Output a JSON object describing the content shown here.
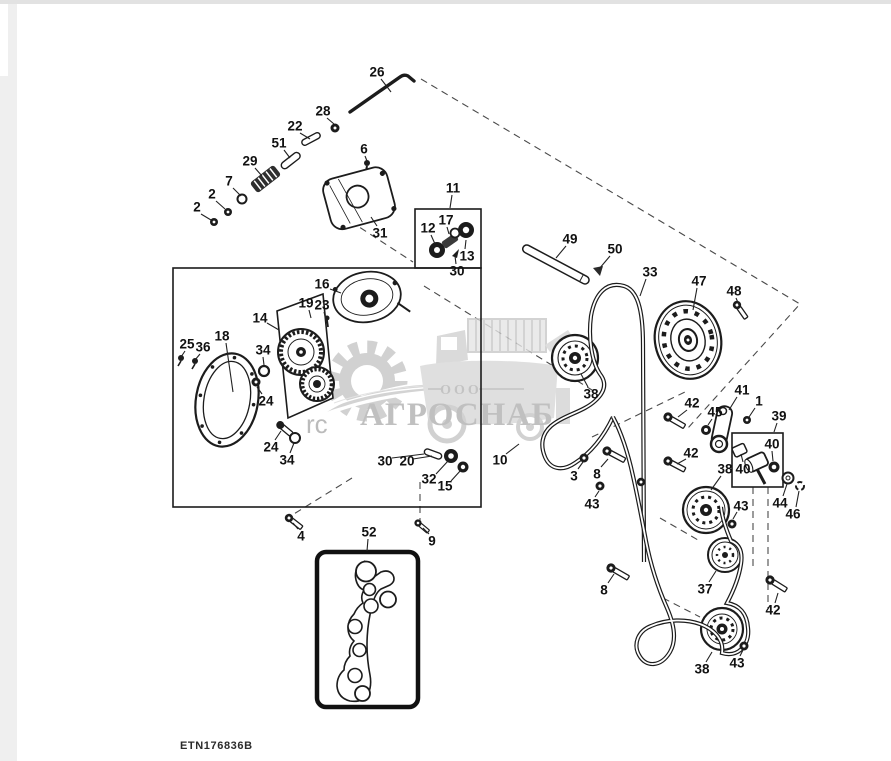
{
  "diagram": {
    "figure_code": "ETN176836B",
    "watermark": {
      "company_type": "ООО",
      "company_name": "АГРОСНАБ",
      "fragment": "rc"
    },
    "callouts": [
      {
        "n": "26",
        "x": 377,
        "y": 72,
        "l": [
          381,
          79,
          391,
          92
        ]
      },
      {
        "n": "28",
        "x": 323,
        "y": 111,
        "l": [
          327,
          118,
          334,
          124
        ]
      },
      {
        "n": "22",
        "x": 295,
        "y": 126,
        "l": [
          300,
          133,
          310,
          139
        ]
      },
      {
        "n": "51",
        "x": 279,
        "y": 143,
        "l": [
          284,
          150,
          290,
          158
        ]
      },
      {
        "n": "29",
        "x": 250,
        "y": 161,
        "l": [
          255,
          168,
          262,
          176
        ]
      },
      {
        "n": "7",
        "x": 229,
        "y": 181,
        "l": [
          233,
          188,
          241,
          196
        ]
      },
      {
        "n": "2",
        "x": 212,
        "y": 194,
        "l": [
          216,
          201,
          225,
          209
        ]
      },
      {
        "n": "2",
        "x": 197,
        "y": 207,
        "l": [
          201,
          214,
          211,
          220
        ]
      },
      {
        "n": "6",
        "x": 364,
        "y": 149,
        "l": [
          365,
          156,
          367,
          161
        ]
      },
      {
        "n": "31",
        "x": 380,
        "y": 233,
        "l": [
          377,
          226,
          371,
          217
        ]
      },
      {
        "n": "11",
        "x": 453,
        "y": 188,
        "l": [
          452,
          195,
          450,
          208
        ]
      },
      {
        "n": "12",
        "x": 428,
        "y": 228,
        "l": [
          431,
          235,
          435,
          244
        ]
      },
      {
        "n": "17",
        "x": 446,
        "y": 220,
        "l": [
          447,
          227,
          449,
          234
        ]
      },
      {
        "n": "13",
        "x": 467,
        "y": 256,
        "l": [
          465,
          249,
          466,
          240
        ]
      },
      {
        "n": "30",
        "x": 457,
        "y": 271,
        "l": [
          456,
          264,
          455,
          256
        ]
      },
      {
        "n": "16",
        "x": 322,
        "y": 284,
        "l": [
          330,
          289,
          341,
          293
        ]
      },
      {
        "n": "19",
        "x": 306,
        "y": 303,
        "l": [
          309,
          310,
          311,
          318
        ]
      },
      {
        "n": "23",
        "x": 322,
        "y": 305,
        "l": [
          324,
          312,
          326,
          320
        ]
      },
      {
        "n": "14",
        "x": 260,
        "y": 318,
        "l": [
          267,
          323,
          279,
          330
        ]
      },
      {
        "n": "18",
        "x": 222,
        "y": 336,
        "l": [
          226,
          343,
          233,
          392
        ]
      },
      {
        "n": "25",
        "x": 187,
        "y": 344,
        "l": [
          185,
          351,
          181,
          357
        ]
      },
      {
        "n": "36",
        "x": 203,
        "y": 347,
        "l": [
          200,
          354,
          195,
          360
        ]
      },
      {
        "n": "34",
        "x": 263,
        "y": 350,
        "l": [
          263,
          357,
          264,
          365
        ]
      },
      {
        "n": "24",
        "x": 266,
        "y": 401,
        "l": [
          262,
          394,
          257,
          387
        ]
      },
      {
        "n": "24",
        "x": 271,
        "y": 447,
        "l": [
          275,
          440,
          281,
          431
        ]
      },
      {
        "n": "34",
        "x": 287,
        "y": 460,
        "l": [
          290,
          453,
          294,
          443
        ]
      },
      {
        "n": "30",
        "x": 385,
        "y": 461,
        "l": [
          392,
          458,
          424,
          454
        ]
      },
      {
        "n": "20",
        "x": 407,
        "y": 461,
        "l": [
          413,
          459,
          432,
          456
        ]
      },
      {
        "n": "32",
        "x": 429,
        "y": 479,
        "l": [
          436,
          474,
          448,
          461
        ]
      },
      {
        "n": "15",
        "x": 445,
        "y": 486,
        "l": [
          451,
          481,
          461,
          470
        ]
      },
      {
        "n": "4",
        "x": 301,
        "y": 536,
        "l": [
          298,
          529,
          293,
          523
        ]
      },
      {
        "n": "52",
        "x": 369,
        "y": 532,
        "l": [
          368,
          539,
          367,
          551
        ]
      },
      {
        "n": "9",
        "x": 432,
        "y": 541,
        "l": [
          429,
          534,
          423,
          528
        ]
      },
      {
        "n": "49",
        "x": 570,
        "y": 239,
        "l": [
          566,
          246,
          556,
          258
        ]
      },
      {
        "n": "50",
        "x": 615,
        "y": 249,
        "l": [
          610,
          256,
          599,
          269
        ]
      },
      {
        "n": "33",
        "x": 650,
        "y": 272,
        "l": [
          646,
          279,
          640,
          296
        ]
      },
      {
        "n": "47",
        "x": 699,
        "y": 281,
        "l": [
          697,
          288,
          693,
          310
        ]
      },
      {
        "n": "48",
        "x": 734,
        "y": 291,
        "l": [
          736,
          298,
          739,
          305
        ]
      },
      {
        "n": "38",
        "x": 591,
        "y": 394,
        "l": [
          588,
          387,
          581,
          374
        ]
      },
      {
        "n": "42",
        "x": 692,
        "y": 403,
        "l": [
          687,
          410,
          678,
          417
        ]
      },
      {
        "n": "41",
        "x": 742,
        "y": 390,
        "l": [
          737,
          397,
          729,
          410
        ]
      },
      {
        "n": "1",
        "x": 759,
        "y": 401,
        "l": [
          755,
          408,
          749,
          417
        ]
      },
      {
        "n": "45",
        "x": 715,
        "y": 412,
        "l": [
          712,
          419,
          708,
          425
        ]
      },
      {
        "n": "39",
        "x": 779,
        "y": 416,
        "l": [
          777,
          423,
          774,
          432
        ]
      },
      {
        "n": "40",
        "x": 772,
        "y": 444,
        "l": [
          772,
          451,
          773,
          461
        ]
      },
      {
        "n": "42",
        "x": 691,
        "y": 453,
        "l": [
          686,
          459,
          677,
          464
        ]
      },
      {
        "n": "38",
        "x": 725,
        "y": 469,
        "l": [
          721,
          476,
          711,
          490
        ]
      },
      {
        "n": "40",
        "x": 743,
        "y": 469,
        "l": [
          743,
          462,
          741,
          454
        ]
      },
      {
        "n": "10",
        "x": 500,
        "y": 460,
        "l": [
          506,
          454,
          519,
          444
        ]
      },
      {
        "n": "3",
        "x": 574,
        "y": 476,
        "l": [
          578,
          469,
          583,
          462
        ]
      },
      {
        "n": "8",
        "x": 597,
        "y": 474,
        "l": [
          601,
          467,
          608,
          459
        ]
      },
      {
        "n": "43",
        "x": 592,
        "y": 504,
        "l": [
          595,
          497,
          599,
          491
        ]
      },
      {
        "n": "43",
        "x": 741,
        "y": 506,
        "l": [
          737,
          512,
          733,
          519
        ]
      },
      {
        "n": "44",
        "x": 780,
        "y": 503,
        "l": [
          783,
          496,
          787,
          484
        ]
      },
      {
        "n": "46",
        "x": 793,
        "y": 514,
        "l": [
          796,
          507,
          799,
          491
        ]
      },
      {
        "n": "8",
        "x": 604,
        "y": 590,
        "l": [
          608,
          583,
          614,
          574
        ]
      },
      {
        "n": "37",
        "x": 705,
        "y": 589,
        "l": [
          709,
          582,
          716,
          571
        ]
      },
      {
        "n": "42",
        "x": 773,
        "y": 610,
        "l": [
          775,
          603,
          778,
          593
        ]
      },
      {
        "n": "38",
        "x": 702,
        "y": 669,
        "l": [
          706,
          662,
          712,
          652
        ]
      },
      {
        "n": "43",
        "x": 737,
        "y": 663,
        "l": [
          740,
          656,
          743,
          650
        ]
      }
    ]
  }
}
